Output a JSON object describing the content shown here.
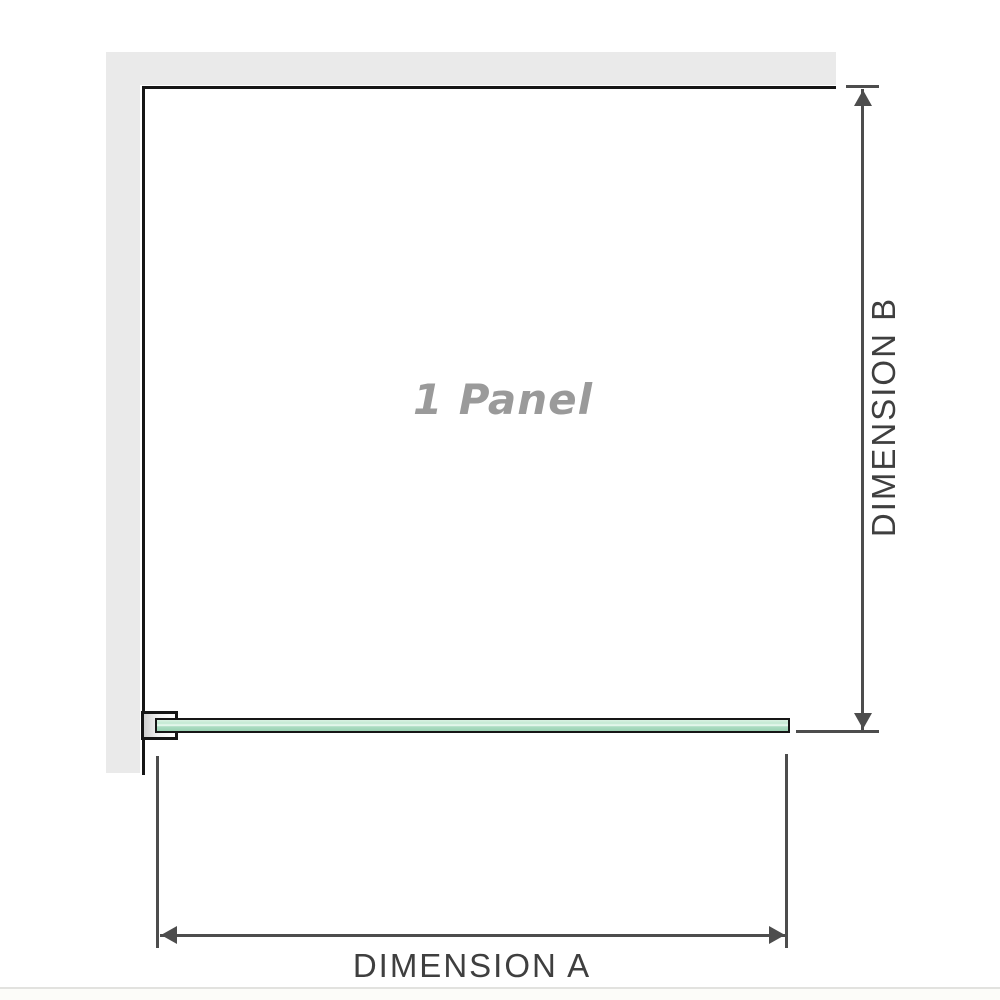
{
  "diagram": {
    "panel_label": "1 Panel",
    "dimension_a": {
      "label": "DIMENSION A"
    },
    "dimension_b": {
      "label": "DIMENSION B"
    },
    "colors": {
      "wall_gray": "#eaeaea",
      "outline_black": "#161616",
      "dimension_line_gray": "#4d4d4d",
      "glass_green": "#aadcc1",
      "panel_label_gray": "#9a9a9a",
      "dimension_label_gray": "#3f3f3f"
    }
  }
}
